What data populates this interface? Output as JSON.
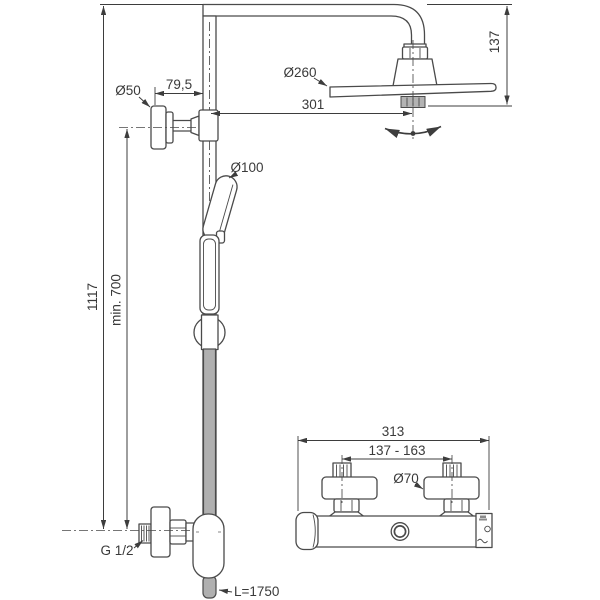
{
  "drawing": {
    "views": {
      "main": {
        "labels": {
          "overall_height": "1117",
          "min_height": "min. 700",
          "bracket_diameter": "Ø50",
          "bracket_projection": "79,5",
          "head_diameter": "Ø260",
          "arm_reach": "301",
          "head_drop": "137",
          "handspray_diameter": "Ø100",
          "inlet_thread": "G 1/2",
          "hose_length": "L=1750"
        }
      },
      "mixer": {
        "labels": {
          "overall_width": "313",
          "inlet_spacing": "137 - 163",
          "escutcheon_diameter": "Ø70"
        }
      }
    },
    "colors": {
      "background": "#ffffff",
      "line": "#4a4a4a",
      "dimension": "#3d3d3d",
      "text": "#3a3a3a",
      "hose_fill": "#b0b0b0",
      "knurl_fill": "#b3b3b3"
    }
  }
}
